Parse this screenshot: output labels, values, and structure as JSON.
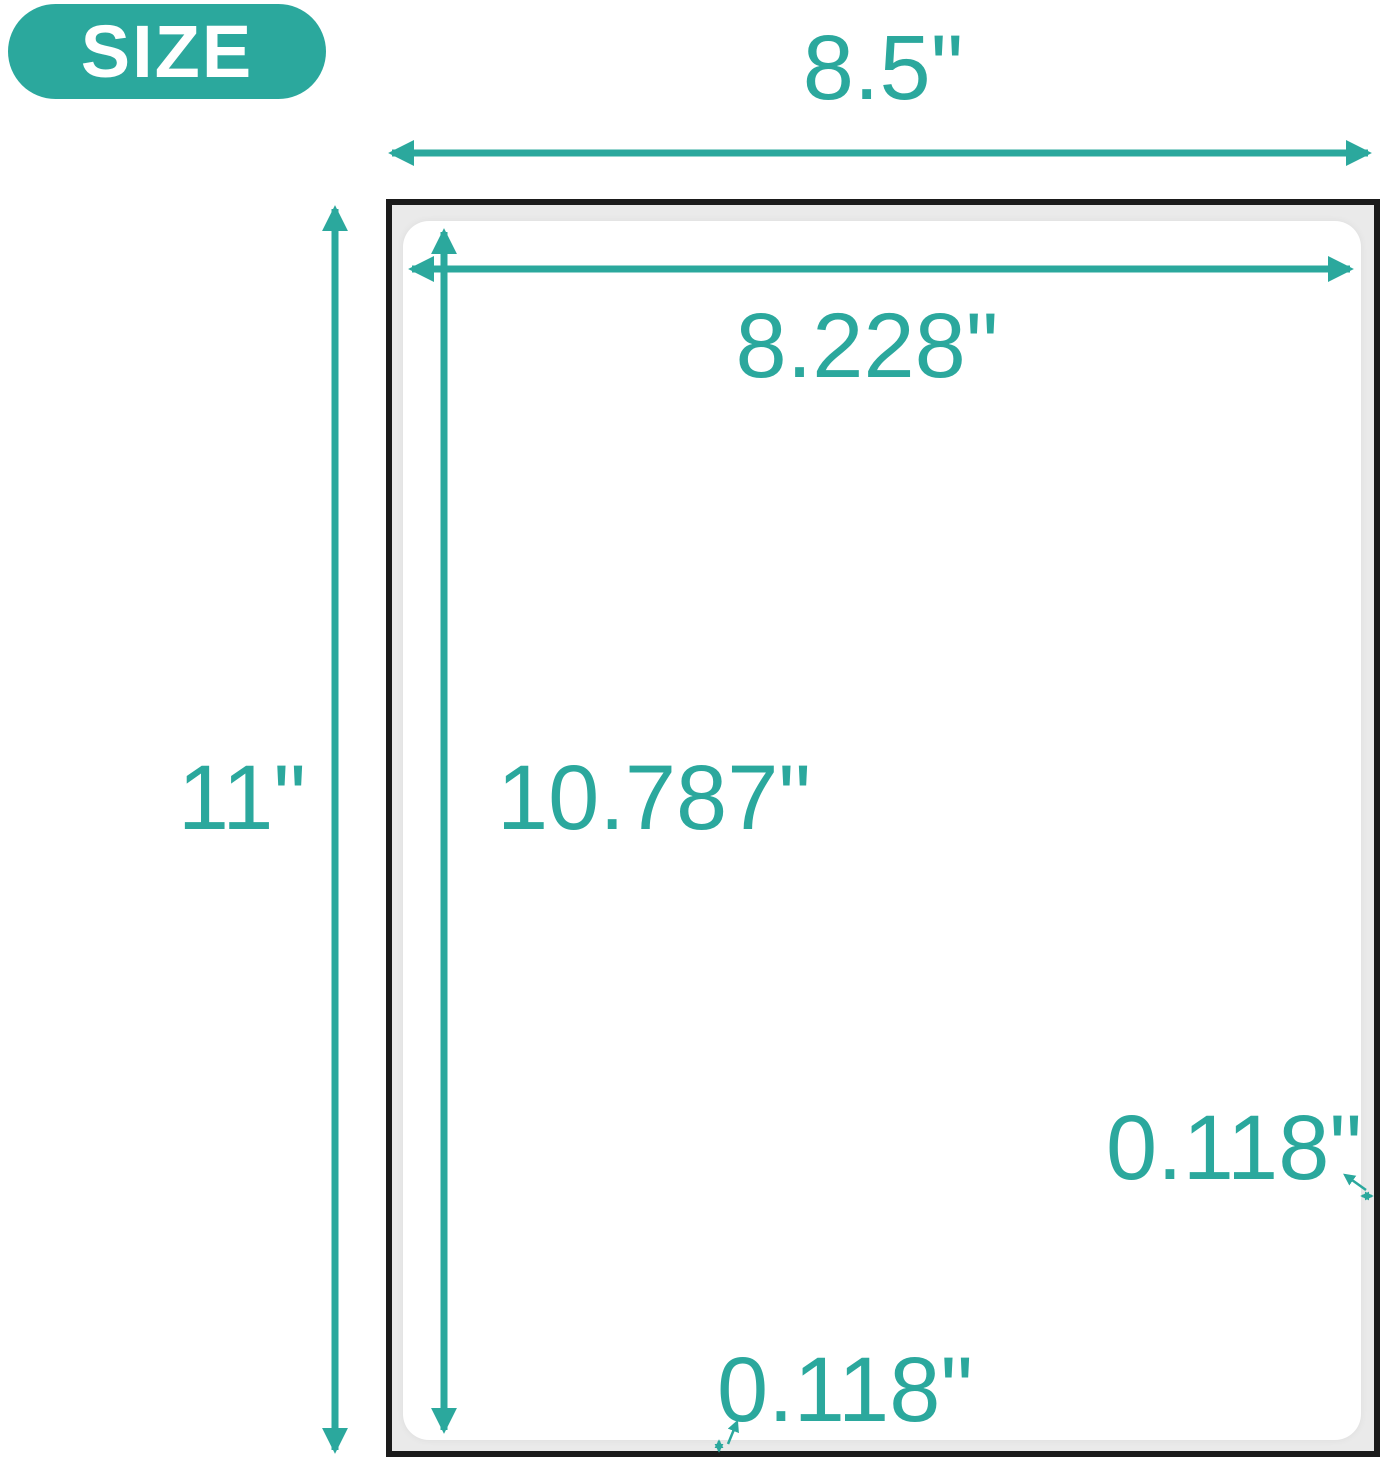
{
  "diagram": {
    "badge": "SIZE",
    "sheet": {
      "width": "8.5\"",
      "height": "11\""
    },
    "label": {
      "width": "8.228\"",
      "height": "10.787\""
    },
    "margin": {
      "right": "0.118\"",
      "bottom": "0.118\""
    },
    "colors": {
      "accent": "#2ba89d",
      "sheet_border": "#1b1b1b",
      "liner_gray": "#eaeaea",
      "label_bg": "#ffffff",
      "badge_text": "#ffffff"
    }
  }
}
